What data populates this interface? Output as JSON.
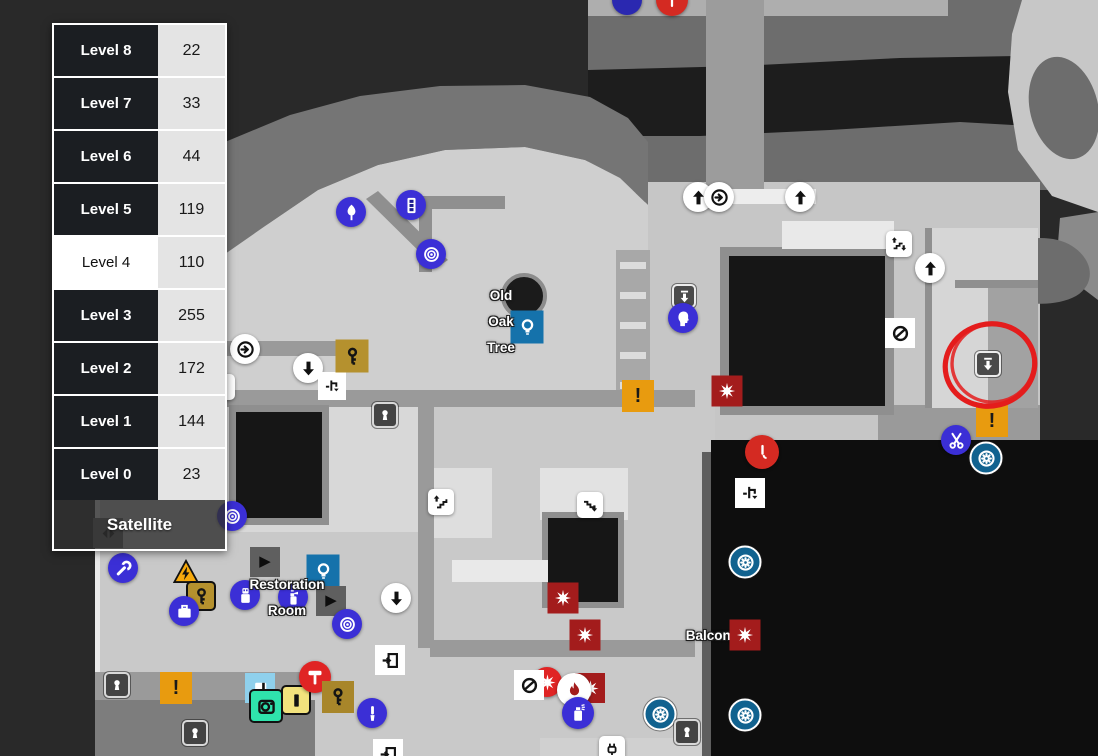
{
  "panel": {
    "levels": [
      {
        "label": "Level 8",
        "count": "22"
      },
      {
        "label": "Level 7",
        "count": "33"
      },
      {
        "label": "Level 6",
        "count": "44"
      },
      {
        "label": "Level 5",
        "count": "119"
      },
      {
        "label": "Level 4",
        "count": "110"
      },
      {
        "label": "Level 3",
        "count": "255"
      },
      {
        "label": "Level 2",
        "count": "172"
      },
      {
        "label": "Level 1",
        "count": "144"
      },
      {
        "label": "Level 0",
        "count": "23"
      }
    ],
    "selected_level": "Level 4",
    "satellite_label": "Satellite"
  },
  "map": {
    "colors": {
      "annotation_red": "#e41c1c",
      "marker_indigo": "#3b2fd6",
      "marker_steel_blue": "#1572ab",
      "marker_fan_blue": "#11628f",
      "marker_orange": "#e89b0f",
      "marker_dark_red": "#a31c1c",
      "marker_gold": "#b5912e",
      "terrain_light": "#cfcfcf",
      "terrain_dark": "#1d1d1d"
    },
    "labels": [
      {
        "name": "old-oak-tree-label",
        "lines": [
          "Old",
          "Oak",
          "Tree"
        ],
        "x": 501,
        "y": 283
      },
      {
        "name": "restoration-room-label",
        "lines": [
          "Restoration",
          "Room"
        ],
        "x": 287,
        "y": 572
      },
      {
        "name": "balcony-label",
        "lines": [
          "Balcony"
        ],
        "x": 712,
        "y": 623
      }
    ],
    "annotation": {
      "name": "red-circle-annotation",
      "cx": 990,
      "cy": 365,
      "rx": 45,
      "ry": 41,
      "rot": -14
    },
    "markers": [
      {
        "n": "stairs-down-square-edge",
        "s": "sq-white",
        "g": "arrowDownBar",
        "x": 222,
        "y": 387
      },
      {
        "n": "nav-arrows-diamond",
        "s": "dia-gray",
        "g": "navArrows",
        "x": 108,
        "y": 533
      },
      {
        "n": "down-arrow-square",
        "s": "sq-dark",
        "g": "arrowDownBar",
        "x": 684,
        "y": 296,
        "d": 24
      },
      {
        "n": "bust-marker",
        "s": "c-indigo",
        "g": "head",
        "x": 683,
        "y": 318
      },
      {
        "n": "old-oak-tree",
        "s": "tree",
        "g": "",
        "x": 524,
        "y": 296,
        "d": 46
      },
      {
        "n": "hint-diamond",
        "s": "dia-blue",
        "g": "bulb",
        "x": 527,
        "y": 327,
        "d": 33
      },
      {
        "n": "lamp-marker",
        "s": "c-indigo",
        "g": "tree2",
        "x": 351,
        "y": 212
      },
      {
        "n": "panel-marker",
        "s": "c-indigo",
        "g": "panel3",
        "x": 411,
        "y": 205
      },
      {
        "n": "target-marker",
        "s": "c-indigo",
        "g": "target",
        "x": 431,
        "y": 254
      },
      {
        "n": "extract-up-arrow",
        "s": "c-white",
        "g": "arrowUp",
        "x": 698,
        "y": 197
      },
      {
        "n": "extract-ring-arrow",
        "s": "c-white",
        "g": "ringArrow",
        "x": 719,
        "y": 197
      },
      {
        "n": "extract-up-arrow",
        "s": "c-white",
        "g": "arrowUp",
        "x": 800,
        "y": 197
      },
      {
        "n": "stairs-updown-square",
        "s": "sq-white",
        "g": "stairsUpDown",
        "x": 899,
        "y": 244
      },
      {
        "n": "extract-up-arrow",
        "s": "c-white",
        "g": "arrowUp",
        "x": 930,
        "y": 268
      },
      {
        "n": "no-entry-diamond",
        "s": "dia-white",
        "g": "noEntry",
        "x": 900,
        "y": 333
      },
      {
        "n": "extract-ring-arrow",
        "s": "c-white",
        "g": "ringArrow",
        "x": 245,
        "y": 349
      },
      {
        "n": "extract-down-arrow",
        "s": "c-white",
        "g": "arrowDown",
        "x": 308,
        "y": 368
      },
      {
        "n": "pipe-diamond",
        "s": "dia-white",
        "g": "pipe",
        "x": 332,
        "y": 386,
        "d": 28
      },
      {
        "n": "key-diamond",
        "s": "dia-gold",
        "g": "key",
        "x": 352,
        "y": 356,
        "d": 33
      },
      {
        "n": "keyhole-square",
        "s": "sq-key",
        "g": "keyhole",
        "x": 385,
        "y": 415
      },
      {
        "n": "danger-diamond",
        "s": "dia-orange",
        "g": "exclaim",
        "x": 638,
        "y": 396,
        "d": 32
      },
      {
        "n": "hazard-star-diamond",
        "s": "dia-red",
        "g": "star8",
        "x": 727,
        "y": 391,
        "d": 31
      },
      {
        "n": "red-tool-marker",
        "s": "c-red",
        "g": "lever",
        "x": 762,
        "y": 452,
        "d": 34
      },
      {
        "n": "pipe-diamond",
        "s": "dia-white",
        "g": "pipe",
        "x": 750,
        "y": 493
      },
      {
        "n": "fan-marker",
        "s": "c-fan",
        "g": "fan",
        "x": 745,
        "y": 562,
        "d": 33
      },
      {
        "n": "target-marker",
        "s": "c-indigo",
        "g": "target",
        "x": 232,
        "y": 516
      },
      {
        "n": "stairs-up-square",
        "s": "sq-white",
        "g": "stairsUp",
        "x": 441,
        "y": 502
      },
      {
        "n": "stairs-down-square",
        "s": "sq-white",
        "g": "stairsDown",
        "x": 590,
        "y": 505
      },
      {
        "n": "hazard-star-diamond",
        "s": "dia-red",
        "g": "star8",
        "x": 563,
        "y": 598,
        "d": 31
      },
      {
        "n": "hazard-star-diamond",
        "s": "dia-red",
        "g": "star8",
        "x": 585,
        "y": 635,
        "d": 31
      },
      {
        "n": "wrench-marker",
        "s": "c-indigo",
        "g": "wrench",
        "x": 123,
        "y": 568
      },
      {
        "n": "electric-warning-triangle",
        "s": "plain",
        "g": "boltTri",
        "x": 186,
        "y": 572,
        "d": 42
      },
      {
        "n": "key-square",
        "s": "sq-gold",
        "g": "key",
        "x": 201,
        "y": 596,
        "d": 30
      },
      {
        "n": "briefcase-marker",
        "s": "c-indigo",
        "g": "briefcase",
        "x": 184,
        "y": 611
      },
      {
        "n": "play-diamond",
        "s": "dia-gray",
        "g": "play",
        "x": 265,
        "y": 562
      },
      {
        "n": "usb-marker",
        "s": "c-indigo",
        "g": "usb",
        "x": 245,
        "y": 595
      },
      {
        "n": "hint-diamond",
        "s": "dia-blue",
        "g": "bulb",
        "x": 323,
        "y": 571,
        "d": 33
      },
      {
        "n": "spray-marker",
        "s": "c-indigo",
        "g": "sprayBottle",
        "x": 293,
        "y": 597
      },
      {
        "n": "play-diamond",
        "s": "dia-gray",
        "g": "play",
        "x": 331,
        "y": 601
      },
      {
        "n": "target-marker",
        "s": "c-indigo",
        "g": "target",
        "x": 347,
        "y": 624
      },
      {
        "n": "extract-down-arrow",
        "s": "c-white",
        "g": "arrowDown",
        "x": 396,
        "y": 598
      },
      {
        "n": "door-diamond",
        "s": "dia-white",
        "g": "door",
        "x": 390,
        "y": 660
      },
      {
        "n": "keyhole-square",
        "s": "sq-key",
        "g": "keyhole",
        "x": 117,
        "y": 685
      },
      {
        "n": "danger-diamond",
        "s": "dia-orange",
        "g": "exclaim",
        "x": 176,
        "y": 688,
        "d": 32
      },
      {
        "n": "keyhole-square",
        "s": "sq-key",
        "g": "keyhole",
        "x": 195,
        "y": 733
      },
      {
        "n": "photo-diamond",
        "s": "dia-sky",
        "g": "photoCard",
        "x": 260,
        "y": 688,
        "d": 30
      },
      {
        "n": "camera-square",
        "s": "sq-mint",
        "g": "camera",
        "x": 266,
        "y": 706,
        "d": 34
      },
      {
        "n": "battery-square",
        "s": "sq-yellow",
        "g": "batteryBar",
        "x": 296,
        "y": 700,
        "d": 30
      },
      {
        "n": "hammer-marker",
        "s": "c-red2",
        "g": "hammer",
        "x": 315,
        "y": 677,
        "d": 32
      },
      {
        "n": "key-diamond",
        "s": "dia-gold2",
        "g": "key",
        "x": 338,
        "y": 697,
        "d": 32
      },
      {
        "n": "tool-marker",
        "s": "c-indigo",
        "g": "brush",
        "x": 372,
        "y": 713
      },
      {
        "n": "door-diamond",
        "s": "dia-white",
        "g": "door",
        "x": 388,
        "y": 754
      },
      {
        "n": "star-circle-marker",
        "s": "c-red2",
        "g": "star8",
        "x": 547,
        "y": 682
      },
      {
        "n": "no-entry-diamond",
        "s": "dia-white",
        "g": "noEntry",
        "x": 529,
        "y": 685
      },
      {
        "n": "hazard-star-diamond",
        "s": "dia-red",
        "g": "star8",
        "x": 590,
        "y": 688,
        "d": 30
      },
      {
        "n": "flame-circle-marker",
        "s": "c-white",
        "g": "flame",
        "x": 574,
        "y": 690,
        "d": 34,
        "gc": "#a31c1c"
      },
      {
        "n": "spray-can-marker",
        "s": "c-indigo",
        "g": "sprayCan",
        "x": 578,
        "y": 713,
        "d": 32
      },
      {
        "n": "fan-marker",
        "s": "c-fan",
        "g": "fan",
        "x": 660,
        "y": 714,
        "d": 33
      },
      {
        "n": "keyhole-square",
        "s": "sq-key",
        "g": "keyhole",
        "x": 687,
        "y": 732
      },
      {
        "n": "hazard-star-diamond",
        "s": "dia-red",
        "g": "star8",
        "x": 745,
        "y": 635,
        "d": 31,
        "z": 110
      },
      {
        "n": "fan-marker",
        "s": "c-fan",
        "g": "fan",
        "x": 745,
        "y": 715,
        "d": 33
      },
      {
        "n": "plug-square",
        "s": "sq-white",
        "g": "plug",
        "x": 612,
        "y": 749
      },
      {
        "n": "danger-diamond",
        "s": "dia-orange",
        "g": "exclaim",
        "x": 992,
        "y": 421,
        "d": 32
      },
      {
        "n": "scissors-marker",
        "s": "c-indigo",
        "g": "scissors",
        "x": 956,
        "y": 440
      },
      {
        "n": "fan-marker",
        "s": "c-fan",
        "g": "fan",
        "x": 986,
        "y": 458,
        "d": 33
      },
      {
        "n": "annotated-down-square",
        "s": "sq-dark",
        "g": "arrowDownBar",
        "x": 988,
        "y": 364,
        "d": 26
      },
      {
        "n": "blue-circle-partial",
        "s": "c-indigo2",
        "g": "",
        "x": 627,
        "y": 0
      },
      {
        "n": "red-circle-partial",
        "s": "c-red",
        "g": "line",
        "x": 672,
        "y": 0,
        "d": 32
      }
    ]
  }
}
